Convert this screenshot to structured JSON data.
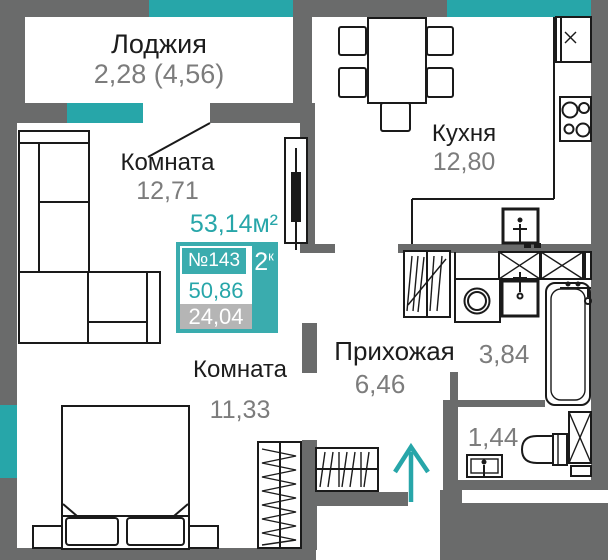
{
  "palette": {
    "accent": "#27a6a9",
    "badge_teal": "#3aacae",
    "wall_gray": "#6a6b6b",
    "number_gray": "#7c7c7c",
    "label_black": "#1c1c1c",
    "chip_gray": "#b5b5b5",
    "line_black": "#1a1a1a"
  },
  "rooms": {
    "loggia": {
      "label": "Лоджия",
      "area": "2,28 (4,56)"
    },
    "living": {
      "label": "Комната",
      "area": "12,71"
    },
    "kitchen": {
      "label": "Кухня",
      "area": "12,80"
    },
    "bedroom": {
      "label": "Комната",
      "area": "11,33"
    },
    "hallway": {
      "label": "Прихожая",
      "area": "6,46"
    },
    "bathroom": {
      "area": "3,84"
    },
    "wc": {
      "area": "1,44"
    }
  },
  "badge": {
    "total_area": "53,14м²",
    "flat_number": "№143",
    "rooms_count": "2",
    "rooms_suffix": "к",
    "living_area": "50,86",
    "secondary_area": "24,04"
  },
  "icons": {
    "entrance_direction": "arrow-up-icon",
    "storage_boxes": "crossed-box-icon",
    "windows": "teal-window-segment"
  }
}
